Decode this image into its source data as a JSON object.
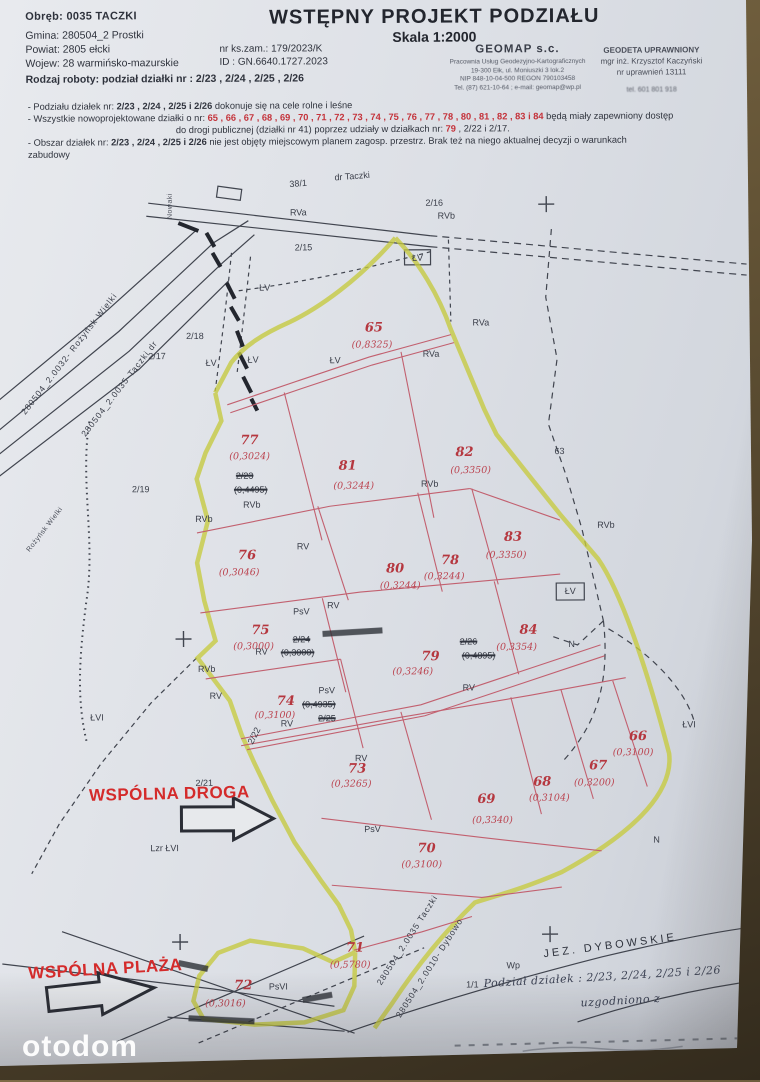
{
  "watermark": "otodom",
  "header": {
    "left": {
      "obreb": "Obręb: 0035 TACZKI",
      "lines": [
        "Gmina: 280504_2 Prostki",
        "Powiat: 2805 ełcki",
        "Wojew: 28 warmińsko-mazurskie"
      ],
      "rodzaj": "Rodzaj roboty: podział działki nr : 2/23 , 2/24 , 2/25 , 2/26",
      "nr_ks": "nr ks.zam.:   179/2023/K",
      "id": "ID : GN.6640.1727.2023"
    },
    "title": "WSTĘPNY PROJEKT PODZIAŁU",
    "scale": "Skala 1:2000",
    "firm": {
      "name": "GEOMAP s.c.",
      "lines": [
        "Pracownia Usług Geodezyjno-Kartograficznych",
        "19-300 Ełk, ul. Moniuszki 3 lok.2",
        "NIP 848-10-04-500   REGON 790103458",
        "Tel. (87) 621-10-64 ; e-mail: geomap@wp.pl"
      ]
    },
    "surveyor": {
      "lines": [
        "GEODETA UPRAWNIONY",
        "mgr inż. Krzysztof Kaczyński",
        "nr uprawnień 13111"
      ],
      "phone": "tel. 601 801 918"
    }
  },
  "notes": {
    "lines": [
      {
        "parts": [
          {
            "t": "- Podziału działek  nr: "
          },
          {
            "t": "2/23 , 2/24 , 2/25  i  2/26",
            "b": 1
          },
          {
            "t": "  dokonuje się na cele rolne i leśne"
          }
        ]
      },
      {
        "parts": [
          {
            "t": "- Wszystkie nowoprojektowane działki o nr: "
          },
          {
            "t": "65 , 66 , 67 , 68 , 69 , 70 , 71 , 72 , 73 , 74 , 75 , 76 , 77 , 78 , 80 , 81 , 82 , 83 i 84",
            "red": 1
          },
          {
            "t": " będą miały zapewniony  dostęp"
          }
        ]
      },
      {
        "center": 1,
        "parts": [
          {
            "t": "do drogi publicznej (działki nr 41) poprzez udziały w działkach nr: "
          },
          {
            "t": "79",
            "red": 1
          },
          {
            "t": " , 2/22 i 2/17."
          }
        ]
      },
      {
        "parts": [
          {
            "t": "- Obszar działek  nr: "
          },
          {
            "t": "2/23 , 2/24 , 2/25  i  2/26",
            "b": 1
          },
          {
            "t": "  nie jest objęty  miejscowym  planem  zagosp. przestrz.  Brak też na niego aktualnej decyzji o warunkach"
          }
        ]
      },
      {
        "parts": [
          {
            "t": "zabudowy"
          }
        ]
      }
    ]
  },
  "map": {
    "colors": {
      "road_highlight": "#c6ca3f",
      "new_plot_lines": "#c2606f",
      "annotation_red": "#b5373f",
      "ink_black": "#3a3e49"
    },
    "labels": [
      {
        "x": 300,
        "y": 183,
        "t": "38/1",
        "k": "b",
        "r": -4
      },
      {
        "x": 354,
        "y": 176,
        "t": "dr Taczki",
        "k": "b",
        "r": -4
      },
      {
        "x": 300,
        "y": 212,
        "t": "RVa",
        "k": "b"
      },
      {
        "x": 436,
        "y": 203,
        "t": "2/16",
        "k": "b"
      },
      {
        "x": 448,
        "y": 216,
        "t": "RVb",
        "k": "b"
      },
      {
        "x": 305,
        "y": 247,
        "t": "2/15",
        "k": "b"
      },
      {
        "x": 266,
        "y": 287,
        "t": "ŁV",
        "k": "b"
      },
      {
        "x": 419,
        "y": 258,
        "t": "ŁV",
        "k": "b"
      },
      {
        "x": 172,
        "y": 205,
        "t": "Nowaki",
        "k": "rls",
        "r": -90
      },
      {
        "x": 336,
        "y": 360,
        "t": "ŁV",
        "k": "b"
      },
      {
        "x": 432,
        "y": 354,
        "t": "RVa",
        "k": "b"
      },
      {
        "x": 482,
        "y": 323,
        "t": "RVa",
        "k": "b"
      },
      {
        "x": 196,
        "y": 335,
        "t": "2/18",
        "k": "b"
      },
      {
        "x": 158,
        "y": 355,
        "t": "2/17",
        "k": "b"
      },
      {
        "x": 212,
        "y": 362,
        "t": "ŁV",
        "k": "b"
      },
      {
        "x": 254,
        "y": 359,
        "t": "ŁV",
        "k": "b"
      },
      {
        "x": 141,
        "y": 488,
        "t": "2/19",
        "k": "b"
      },
      {
        "x": 204,
        "y": 518,
        "t": "RVb",
        "k": "b"
      },
      {
        "x": 252,
        "y": 504,
        "t": "RVb",
        "k": "b"
      },
      {
        "x": 430,
        "y": 484,
        "t": "RVb",
        "k": "b"
      },
      {
        "x": 560,
        "y": 452,
        "t": "63",
        "k": "b"
      },
      {
        "x": 606,
        "y": 526,
        "t": "RVb",
        "k": "b"
      },
      {
        "x": 303,
        "y": 546,
        "t": "RV",
        "k": "b"
      },
      {
        "x": 301,
        "y": 611,
        "t": "PsV",
        "k": "b"
      },
      {
        "x": 333,
        "y": 605,
        "t": "RV",
        "k": "b"
      },
      {
        "x": 261,
        "y": 651,
        "t": "RV",
        "k": "b"
      },
      {
        "x": 206,
        "y": 668,
        "t": "RVb",
        "k": "b"
      },
      {
        "x": 215,
        "y": 695,
        "t": "RV",
        "k": "b"
      },
      {
        "x": 286,
        "y": 723,
        "t": "RV",
        "k": "b"
      },
      {
        "x": 360,
        "y": 758,
        "t": "RV",
        "k": "b"
      },
      {
        "x": 371,
        "y": 829,
        "t": "PsV",
        "k": "b"
      },
      {
        "x": 468,
        "y": 688,
        "t": "RV",
        "k": "b"
      },
      {
        "x": 570,
        "y": 592,
        "t": "ŁV",
        "k": "b"
      },
      {
        "x": 571,
        "y": 645,
        "t": "N",
        "k": "b"
      },
      {
        "x": 688,
        "y": 726,
        "t": "ŁVI",
        "k": "b"
      },
      {
        "x": 96,
        "y": 716,
        "t": "ŁVI",
        "k": "b"
      },
      {
        "x": 203,
        "y": 782,
        "t": "2/21",
        "k": "b"
      },
      {
        "x": 163,
        "y": 847,
        "t": "Lzr ŁVI",
        "k": "b"
      },
      {
        "x": 253,
        "y": 735,
        "t": "2/22",
        "k": "b",
        "r": -62
      },
      {
        "x": 655,
        "y": 841,
        "t": "N",
        "k": "b"
      },
      {
        "x": 276,
        "y": 986,
        "t": "PsVI",
        "k": "b"
      },
      {
        "x": 511,
        "y": 966,
        "t": "Wp",
        "k": "b"
      },
      {
        "x": 470,
        "y": 985,
        "t": "1/1",
        "k": "b"
      },
      {
        "x": 245,
        "y": 475,
        "t": "2/23",
        "k": "x"
      },
      {
        "x": 251,
        "y": 489,
        "t": "(0,4495)",
        "k": "x"
      },
      {
        "x": 301,
        "y": 639,
        "t": "2/24",
        "k": "x"
      },
      {
        "x": 297,
        "y": 652,
        "t": "(0,3000)",
        "k": "x"
      },
      {
        "x": 326,
        "y": 690,
        "t": "PsV",
        "k": "b"
      },
      {
        "x": 318,
        "y": 704,
        "t": "(0,4935)",
        "k": "x"
      },
      {
        "x": 326,
        "y": 718,
        "t": "2/25",
        "k": "x"
      },
      {
        "x": 468,
        "y": 642,
        "t": "2/26",
        "k": "x"
      },
      {
        "x": 478,
        "y": 656,
        "t": "(0,4895)",
        "k": "x"
      },
      {
        "x": 375,
        "y": 328,
        "t": "65",
        "k": "red"
      },
      {
        "x": 373,
        "y": 345,
        "t": "(0,8325)",
        "k": "area"
      },
      {
        "x": 250,
        "y": 440,
        "t": "77",
        "k": "red"
      },
      {
        "x": 250,
        "y": 456,
        "t": "(0,3024)",
        "k": "area"
      },
      {
        "x": 348,
        "y": 466,
        "t": "81",
        "k": "red"
      },
      {
        "x": 354,
        "y": 486,
        "t": "(0,3244)",
        "k": "area"
      },
      {
        "x": 465,
        "y": 453,
        "t": "82",
        "k": "red"
      },
      {
        "x": 471,
        "y": 471,
        "t": "(0,3350)",
        "k": "area"
      },
      {
        "x": 513,
        "y": 538,
        "t": "83",
        "k": "red"
      },
      {
        "x": 506,
        "y": 556,
        "t": "(0,3350)",
        "k": "area"
      },
      {
        "x": 247,
        "y": 555,
        "t": "76",
        "k": "red"
      },
      {
        "x": 239,
        "y": 572,
        "t": "(0,3046)",
        "k": "area"
      },
      {
        "x": 395,
        "y": 569,
        "t": "80",
        "k": "red"
      },
      {
        "x": 400,
        "y": 586,
        "t": "(0,3244)",
        "k": "area"
      },
      {
        "x": 450,
        "y": 561,
        "t": "78",
        "k": "red"
      },
      {
        "x": 444,
        "y": 577,
        "t": "(0,3244)",
        "k": "area"
      },
      {
        "x": 260,
        "y": 630,
        "t": "75",
        "k": "red"
      },
      {
        "x": 253,
        "y": 646,
        "t": "(0,3000)",
        "k": "area"
      },
      {
        "x": 528,
        "y": 631,
        "t": "84",
        "k": "red"
      },
      {
        "x": 516,
        "y": 648,
        "t": "(0,3354)",
        "k": "area"
      },
      {
        "x": 430,
        "y": 657,
        "t": "79",
        "k": "red"
      },
      {
        "x": 412,
        "y": 672,
        "t": "(0,3246)",
        "k": "area"
      },
      {
        "x": 285,
        "y": 701,
        "t": "74",
        "k": "red"
      },
      {
        "x": 274,
        "y": 715,
        "t": "(0,3100)",
        "k": "area"
      },
      {
        "x": 356,
        "y": 769,
        "t": "73",
        "k": "red"
      },
      {
        "x": 350,
        "y": 784,
        "t": "(0,3265)",
        "k": "area"
      },
      {
        "x": 485,
        "y": 800,
        "t": "69",
        "k": "red"
      },
      {
        "x": 491,
        "y": 821,
        "t": "(0,3340)",
        "k": "area"
      },
      {
        "x": 541,
        "y": 783,
        "t": "68",
        "k": "red"
      },
      {
        "x": 548,
        "y": 799,
        "t": "(0,3104)",
        "k": "area"
      },
      {
        "x": 597,
        "y": 767,
        "t": "67",
        "k": "red"
      },
      {
        "x": 593,
        "y": 784,
        "t": "(0,3200)",
        "k": "area"
      },
      {
        "x": 637,
        "y": 738,
        "t": "66",
        "k": "red"
      },
      {
        "x": 632,
        "y": 754,
        "t": "(0,3100)",
        "k": "area"
      },
      {
        "x": 425,
        "y": 849,
        "t": "70",
        "k": "red"
      },
      {
        "x": 420,
        "y": 865,
        "t": "(0,3100)",
        "k": "area"
      },
      {
        "x": 353,
        "y": 948,
        "t": "71",
        "k": "red"
      },
      {
        "x": 348,
        "y": 965,
        "t": "(0,5780)",
        "k": "area"
      },
      {
        "x": 241,
        "y": 985,
        "t": "72",
        "k": "red"
      },
      {
        "x": 223,
        "y": 1003,
        "t": "(0,3016)",
        "k": "area"
      },
      {
        "x": 70,
        "y": 352,
        "t": "280504_2.0032- Rożyńsk Wielki",
        "k": "rl",
        "r": -52
      },
      {
        "x": 120,
        "y": 387,
        "t": "280504_2.0035-Taczki  dr",
        "k": "rl",
        "r": -52
      },
      {
        "x": 45,
        "y": 528,
        "t": "Rożyńsk Wielki",
        "k": "rls",
        "r": -52
      },
      {
        "x": 405,
        "y": 940,
        "t": "280504_2.0035 Taczki",
        "k": "rl",
        "r": -57
      },
      {
        "x": 427,
        "y": 968,
        "t": "280504_2.0010- Dybowo",
        "k": "rl",
        "r": -57
      },
      {
        "x": 608,
        "y": 947,
        "t": "JEZ. DYBOWSKIE",
        "k": "lake",
        "r": -7
      },
      {
        "x": 168,
        "y": 793,
        "t": "WSPÓLNA DROGA",
        "k": "wr",
        "r": -1
      },
      {
        "x": 103,
        "y": 968,
        "t": "WSPÓLNA PLAŻA",
        "k": "wr",
        "r": -3
      },
      {
        "x": 600,
        "y": 978,
        "t": "Podział działek : 2/23, 2/24, 2/25 i 2/26",
        "k": "hw",
        "r": -3
      },
      {
        "x": 618,
        "y": 1002,
        "t": "uzgodniono z",
        "k": "hw",
        "r": -3
      }
    ]
  }
}
